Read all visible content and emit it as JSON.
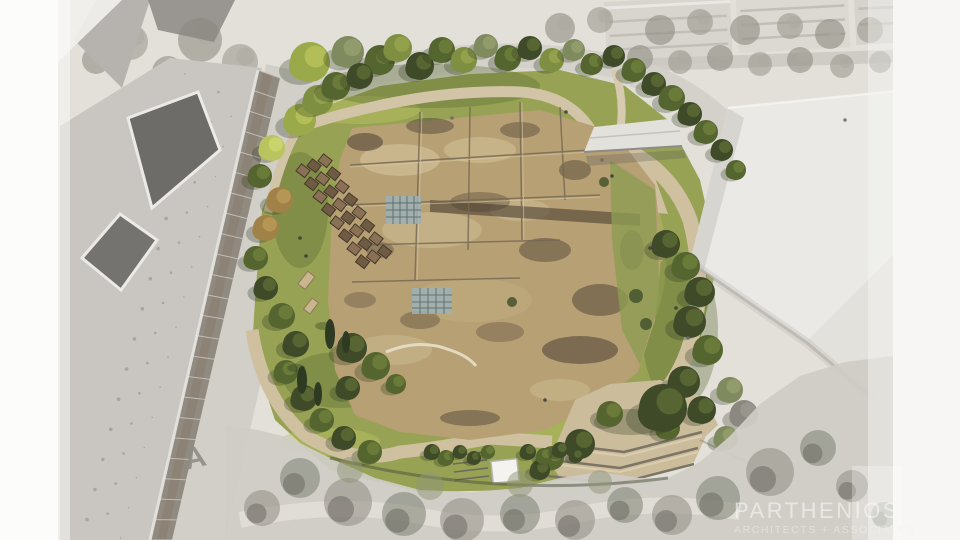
{
  "watermark": {
    "brand": "PARTHENIOS",
    "tagline": "ARCHITECTS + ASSOCIATES",
    "text_color": "#f8f8f6"
  },
  "palette": {
    "excavation_tan": "#b7a074",
    "excavation_light": "#cdbb92",
    "excavation_dark": "#55483a",
    "lawn_green": "#97a254",
    "tree_dark_green": "#3e4a28",
    "tree_light_green": "#7e8f42",
    "tree_yellow_green": "#b9c45f",
    "tree_autumn": "#a08147",
    "path_tan": "#cfc0a0",
    "massing_white": "#eae9e5",
    "context_gray": "#c9c6c1",
    "faded_photo_gray": "#d5d2cb",
    "glazing_gray": "#8b8178",
    "pool_grid_blue": "#9fb0b4",
    "white_margin": "#fbfbfa"
  }
}
